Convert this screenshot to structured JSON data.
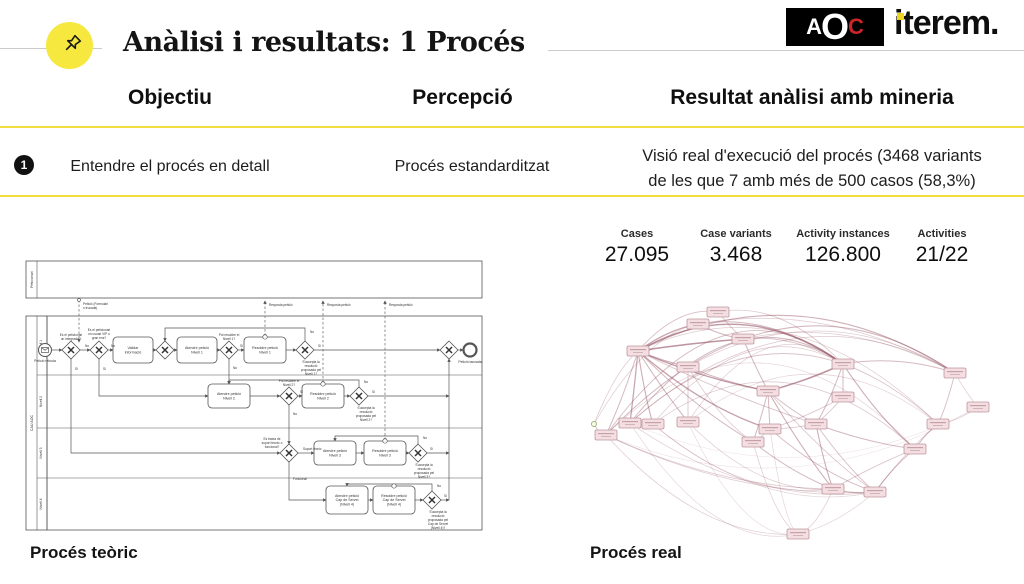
{
  "slide": {
    "title": "Anàlisi i resultats: 1 Procés"
  },
  "logos": {
    "aoc_a": "A",
    "aoc_o": "O",
    "aoc_c": "C",
    "iterem": "iterem."
  },
  "table": {
    "headers": [
      "Objectiu",
      "Percepció",
      "Resultat anàlisi amb mineria"
    ],
    "rows": [
      {
        "num": "1",
        "objectiu": "Entendre el procés en detall",
        "percepcio": "Procés estandarditzat",
        "resultat_lines": [
          "Visió real d'execució del procés (3468 variants",
          "de les que 7 amb més de 500 casos (58,3%)"
        ]
      }
    ]
  },
  "stats": [
    {
      "label": "Cases",
      "value": "27.095"
    },
    {
      "label": "Case variants",
      "value": "3.468"
    },
    {
      "label": "Activity instances",
      "value": "126.800"
    },
    {
      "label": "Activities",
      "value": "21/22"
    }
  ],
  "captions": {
    "left": "Procés teòric",
    "right": "Procés real"
  },
  "colors": {
    "accent_yellow": "#F2DD3E",
    "pin_yellow": "#F6E83F",
    "aoc_red": "#C9252B",
    "iterem_dot_yellow": "#EFD51D",
    "graph_edge": "#945062",
    "graph_node_fill": "#f3dee2",
    "graph_node_border": "#c095a0",
    "graph_start_green": "#86a544",
    "bpmn_stroke": "#555555"
  },
  "bpmn": {
    "pools": [
      {
        "label": "Peticionari",
        "x": 1,
        "y": 1,
        "w": 456,
        "h": 37,
        "lanes": []
      },
      {
        "label": "CAU AOC",
        "x": 1,
        "y": 56,
        "w": 456,
        "h": 214,
        "lanes": [
          {
            "label": "Nivell 1",
            "h": 59
          },
          {
            "label": "Nivell 2",
            "h": 53
          },
          {
            "label": "Nivell 3",
            "h": 50
          },
          {
            "label": "Nivell 4",
            "h": 52
          }
        ]
      }
    ],
    "start": {
      "x": 20,
      "y": 90,
      "label": "Petició rebuda"
    },
    "end": {
      "x": 445,
      "y": 90,
      "label": "Petició tancada"
    },
    "tasks": [
      {
        "x": 108,
        "y": 90,
        "w": 40,
        "h": 26,
        "lines": [
          "Validar",
          "informació"
        ]
      },
      {
        "x": 172,
        "y": 90,
        "w": 40,
        "h": 26,
        "lines": [
          "Atendre petició",
          "Nivell 1"
        ]
      },
      {
        "x": 240,
        "y": 90,
        "w": 42,
        "h": 26,
        "top": true,
        "lines": [
          "Resoldre petició",
          "Nivell 1"
        ]
      },
      {
        "x": 204,
        "y": 136,
        "w": 42,
        "h": 24,
        "lines": [
          "Atendre petició",
          "Nivell 2"
        ]
      },
      {
        "x": 298,
        "y": 136,
        "w": 42,
        "h": 24,
        "top": true,
        "lines": [
          "Resoldre petició",
          "Nivell 2"
        ]
      },
      {
        "x": 310,
        "y": 193,
        "w": 42,
        "h": 24,
        "lines": [
          "Atendre petició",
          "Nivell 3"
        ]
      },
      {
        "x": 360,
        "y": 193,
        "w": 42,
        "h": 24,
        "top": true,
        "lines": [
          "Resoldre petició",
          "Nivell 3"
        ]
      },
      {
        "x": 322,
        "y": 240,
        "w": 42,
        "h": 28,
        "lines": [
          "Atendre petició",
          "Cap de Servei",
          "(Nivell 4)"
        ]
      },
      {
        "x": 369,
        "y": 240,
        "w": 42,
        "h": 28,
        "top": true,
        "lines": [
          "Resoldre petició",
          "Cap de Servei",
          "(Nivell 4)"
        ]
      }
    ],
    "gateways": [
      [
        46,
        90
      ],
      [
        74,
        90
      ],
      [
        140,
        90
      ],
      [
        204,
        90
      ],
      [
        280,
        90
      ],
      [
        424,
        90
      ],
      [
        264,
        136
      ],
      [
        334,
        136
      ],
      [
        264,
        193
      ],
      [
        393,
        193
      ],
      [
        407,
        240
      ]
    ],
    "gwLabels": [
      {
        "x": 46,
        "y": 76,
        "lines": [
          "Es el peticionari",
          "un integrador?"
        ]
      },
      {
        "x": 74,
        "y": 71,
        "lines": [
          "Es el peticionari",
          "un usuari VIP o",
          "gran ens?"
        ]
      },
      {
        "x": 204,
        "y": 76,
        "lines": [
          "Pot resoldre el",
          "Nivell 1?"
        ]
      },
      {
        "x": 286,
        "y": 103,
        "lines": [
          "S'accepta la",
          "resolució",
          "proposada pel",
          "Nivell 1?"
        ]
      },
      {
        "x": 264,
        "y": 122,
        "lines": [
          "Pot resoldre el",
          "Nivell 2?"
        ]
      },
      {
        "x": 341,
        "y": 149,
        "lines": [
          "S'accepta la",
          "resolució",
          "proposada pel",
          "Nivell 2?"
        ]
      },
      {
        "x": 247,
        "y": 180,
        "lines": [
          "Es tracta de",
          "suport tècnic o",
          "funcional?"
        ]
      },
      {
        "x": 399,
        "y": 206,
        "lines": [
          "S'accepta la",
          "resolució",
          "proposada pel",
          "Nivell 3?"
        ]
      },
      {
        "x": 413,
        "y": 253,
        "lines": [
          "S'accepta la",
          "resolució",
          "proposada pel",
          "Cap de Servei",
          "(Nivell 4)?"
        ]
      }
    ],
    "flows": [
      [
        [
          27,
          90
        ],
        [
          37,
          90
        ]
      ],
      [
        [
          55,
          90
        ],
        [
          65,
          90
        ]
      ],
      [
        [
          83,
          90
        ],
        [
          88,
          90
        ]
      ],
      [
        [
          128,
          90
        ],
        [
          131,
          90
        ]
      ],
      [
        [
          149,
          90
        ],
        [
          152,
          90
        ]
      ],
      [
        [
          192,
          90
        ],
        [
          195,
          90
        ]
      ],
      [
        [
          213,
          90
        ],
        [
          219,
          90
        ]
      ],
      [
        [
          261,
          90
        ],
        [
          271,
          90
        ]
      ],
      [
        [
          289,
          90
        ],
        [
          415,
          90
        ]
      ],
      [
        [
          433,
          90
        ],
        [
          438,
          90
        ]
      ],
      [
        [
          280,
          81
        ],
        [
          280,
          68
        ],
        [
          140,
          68
        ],
        [
          140,
          81
        ]
      ],
      [
        [
          204,
          99
        ],
        [
          204,
          124
        ]
      ],
      [
        [
          46,
          99
        ],
        [
          46,
          193
        ],
        [
          255,
          193
        ]
      ],
      [
        [
          74,
          99
        ],
        [
          74,
          136
        ],
        [
          183,
          136
        ]
      ],
      [
        [
          225,
          136
        ],
        [
          255,
          136
        ]
      ],
      [
        [
          273,
          136
        ],
        [
          277,
          136
        ]
      ],
      [
        [
          319,
          136
        ],
        [
          325,
          136
        ]
      ],
      [
        [
          343,
          136
        ],
        [
          424,
          136
        ]
      ],
      [
        [
          334,
          127
        ],
        [
          334,
          120
        ],
        [
          204,
          120
        ],
        [
          204,
          124
        ]
      ],
      [
        [
          264,
          145
        ],
        [
          264,
          184
        ]
      ],
      [
        [
          273,
          193
        ],
        [
          289,
          193
        ]
      ],
      [
        [
          331,
          193
        ],
        [
          339,
          193
        ]
      ],
      [
        [
          381,
          193
        ],
        [
          384,
          193
        ]
      ],
      [
        [
          402,
          193
        ],
        [
          424,
          193
        ]
      ],
      [
        [
          393,
          184
        ],
        [
          393,
          176
        ],
        [
          310,
          176
        ],
        [
          310,
          181
        ]
      ],
      [
        [
          264,
          202
        ],
        [
          264,
          240
        ],
        [
          301,
          240
        ]
      ],
      [
        [
          343,
          240
        ],
        [
          348,
          240
        ]
      ],
      [
        [
          390,
          240
        ],
        [
          398,
          240
        ]
      ],
      [
        [
          416,
          240
        ],
        [
          424,
          240
        ]
      ],
      [
        [
          407,
          231
        ],
        [
          407,
          224
        ],
        [
          322,
          224
        ],
        [
          322,
          226
        ]
      ],
      [
        [
          424,
          240
        ],
        [
          424,
          99
        ]
      ]
    ],
    "flowLabels": [
      {
        "x": 60,
        "y": 87,
        "t": "No"
      },
      {
        "x": 86,
        "y": 87,
        "t": "No"
      },
      {
        "x": 215,
        "y": 87,
        "t": "Si"
      },
      {
        "x": 293,
        "y": 87,
        "t": "Si"
      },
      {
        "x": 285,
        "y": 73,
        "t": "No"
      },
      {
        "x": 208,
        "y": 109,
        "t": "No"
      },
      {
        "x": 50,
        "y": 110,
        "t": "Si"
      },
      {
        "x": 78,
        "y": 110,
        "t": "Si"
      },
      {
        "x": 275,
        "y": 133,
        "t": "Si"
      },
      {
        "x": 347,
        "y": 133,
        "t": "Si"
      },
      {
        "x": 339,
        "y": 123,
        "t": "No"
      },
      {
        "x": 268,
        "y": 155,
        "t": "No"
      },
      {
        "x": 278,
        "y": 190,
        "t": "Suport tècnic"
      },
      {
        "x": 268,
        "y": 220,
        "t": "Funcional"
      },
      {
        "x": 405,
        "y": 190,
        "t": "Si"
      },
      {
        "x": 398,
        "y": 179,
        "t": "No"
      },
      {
        "x": 419,
        "y": 237,
        "t": "Si"
      },
      {
        "x": 412,
        "y": 227,
        "t": "No"
      }
    ],
    "messages": [
      {
        "pts": [
          [
            54,
            40
          ],
          [
            54,
            82
          ]
        ],
        "circle": [
          54,
          40
        ]
      },
      {
        "pts": [
          [
            240,
            76
          ],
          [
            240,
            41
          ]
        ],
        "circle": [
          240,
          76
        ]
      },
      {
        "pts": [
          [
            298,
            123
          ],
          [
            298,
            41
          ]
        ],
        "circle": [
          298,
          123
        ]
      },
      {
        "pts": [
          [
            360,
            180
          ],
          [
            360,
            41
          ]
        ],
        "circle": [
          360,
          180
        ]
      }
    ],
    "msgLabels": [
      {
        "x": 58,
        "y": 45,
        "lines": [
          "Petició (Formulari",
          "o trucada)"
        ]
      },
      {
        "x": 244,
        "y": 46,
        "lines": [
          "Resposta petició"
        ]
      },
      {
        "x": 302,
        "y": 46,
        "lines": [
          "Resposta petició"
        ]
      },
      {
        "x": 364,
        "y": 46,
        "lines": [
          "Resposta petició"
        ]
      }
    ]
  },
  "mining_graph": {
    "nodes": [
      {
        "x": 6,
        "y": 152,
        "type": "start"
      },
      {
        "x": 110,
        "y": 52
      },
      {
        "x": 155,
        "y": 67
      },
      {
        "x": 50,
        "y": 79
      },
      {
        "x": 255,
        "y": 92
      },
      {
        "x": 180,
        "y": 119
      },
      {
        "x": 367,
        "y": 101
      },
      {
        "x": 100,
        "y": 95
      },
      {
        "x": 42,
        "y": 151
      },
      {
        "x": 18,
        "y": 163
      },
      {
        "x": 65,
        "y": 152
      },
      {
        "x": 100,
        "y": 150
      },
      {
        "x": 182,
        "y": 157
      },
      {
        "x": 165,
        "y": 170
      },
      {
        "x": 228,
        "y": 152
      },
      {
        "x": 245,
        "y": 217
      },
      {
        "x": 287,
        "y": 220
      },
      {
        "x": 327,
        "y": 177
      },
      {
        "x": 350,
        "y": 152
      },
      {
        "x": 210,
        "y": 262
      },
      {
        "x": 130,
        "y": 40
      },
      {
        "x": 255,
        "y": 125
      },
      {
        "x": 390,
        "y": 135
      }
    ],
    "edges": [
      [
        9,
        6,
        -150,
        0.5
      ],
      [
        8,
        18,
        -140,
        0.4
      ],
      [
        8,
        6,
        -118,
        0.35
      ],
      [
        10,
        17,
        -108,
        0.35
      ],
      [
        3,
        4,
        -66,
        0.85
      ],
      [
        3,
        6,
        -92,
        0.6
      ],
      [
        11,
        4,
        -88,
        0.3
      ],
      [
        9,
        4,
        -128,
        0.45
      ],
      [
        10,
        4,
        -84,
        0.3
      ],
      [
        8,
        4,
        -104,
        0.5
      ],
      [
        3,
        18,
        -108,
        0.3
      ],
      [
        7,
        6,
        -78,
        0.3
      ],
      [
        3,
        20,
        -26,
        0.45
      ],
      [
        20,
        4,
        -38,
        0.35
      ],
      [
        1,
        4,
        -32,
        0.55
      ],
      [
        2,
        4,
        -18,
        0.45
      ],
      [
        9,
        17,
        -158,
        0.25
      ],
      [
        11,
        18,
        -98,
        0.25
      ],
      [
        0,
        1,
        -40,
        0.3
      ],
      [
        1,
        6,
        -48,
        0.3
      ],
      [
        2,
        6,
        -40,
        0.3
      ],
      [
        0,
        3,
        -18,
        0.35
      ],
      [
        0,
        9,
        6,
        0.4
      ],
      [
        3,
        1,
        -8,
        0.7
      ],
      [
        3,
        2,
        -2,
        0.9
      ],
      [
        3,
        5,
        8,
        0.8
      ],
      [
        3,
        7,
        2,
        0.6
      ],
      [
        3,
        8,
        4,
        0.7
      ],
      [
        3,
        9,
        8,
        0.5
      ],
      [
        3,
        10,
        12,
        0.6
      ],
      [
        3,
        11,
        4,
        0.55
      ],
      [
        3,
        12,
        18,
        0.75
      ],
      [
        3,
        13,
        12,
        0.5
      ],
      [
        3,
        14,
        8,
        0.4
      ],
      [
        7,
        11,
        2,
        0.4
      ],
      [
        7,
        5,
        4,
        0.5
      ],
      [
        1,
        2,
        4,
        0.5
      ],
      [
        2,
        5,
        2,
        0.5
      ],
      [
        20,
        2,
        2,
        0.4
      ],
      [
        4,
        5,
        4,
        0.9
      ],
      [
        4,
        14,
        8,
        0.5
      ],
      [
        4,
        17,
        12,
        0.6
      ],
      [
        4,
        21,
        2,
        0.5
      ],
      [
        21,
        12,
        4,
        0.4
      ],
      [
        21,
        14,
        2,
        0.4
      ],
      [
        4,
        6,
        -14,
        0.5
      ],
      [
        6,
        18,
        8,
        0.45
      ],
      [
        6,
        22,
        4,
        0.3
      ],
      [
        17,
        18,
        -4,
        0.5
      ],
      [
        18,
        22,
        6,
        0.3
      ],
      [
        5,
        12,
        2,
        0.5
      ],
      [
        5,
        13,
        4,
        0.5
      ],
      [
        5,
        15,
        8,
        0.6
      ],
      [
        5,
        16,
        12,
        0.4
      ],
      [
        5,
        14,
        4,
        0.45
      ],
      [
        12,
        14,
        2,
        0.4
      ],
      [
        13,
        12,
        2,
        0.35
      ],
      [
        9,
        16,
        36,
        0.3
      ],
      [
        9,
        15,
        26,
        0.35
      ],
      [
        8,
        16,
        50,
        0.3
      ],
      [
        10,
        16,
        58,
        0.25
      ],
      [
        11,
        15,
        40,
        0.3
      ],
      [
        8,
        19,
        74,
        0.25
      ],
      [
        9,
        19,
        56,
        0.3
      ],
      [
        12,
        16,
        14,
        0.45
      ],
      [
        13,
        15,
        8,
        0.5
      ],
      [
        14,
        15,
        10,
        0.6
      ],
      [
        14,
        17,
        6,
        0.5
      ],
      [
        15,
        16,
        4,
        0.6
      ],
      [
        16,
        17,
        -6,
        0.5
      ],
      [
        13,
        19,
        34,
        0.3
      ],
      [
        12,
        19,
        44,
        0.25
      ],
      [
        15,
        19,
        18,
        0.3
      ],
      [
        16,
        19,
        12,
        0.25
      ],
      [
        10,
        15,
        44,
        0.3
      ],
      [
        11,
        19,
        64,
        0.2
      ],
      [
        7,
        13,
        16,
        0.35
      ],
      [
        9,
        22,
        92,
        0.12
      ],
      [
        8,
        22,
        84,
        0.12
      ],
      [
        16,
        18,
        -8,
        0.35
      ],
      [
        15,
        17,
        -4,
        0.4
      ],
      [
        14,
        16,
        8,
        0.45
      ]
    ]
  }
}
